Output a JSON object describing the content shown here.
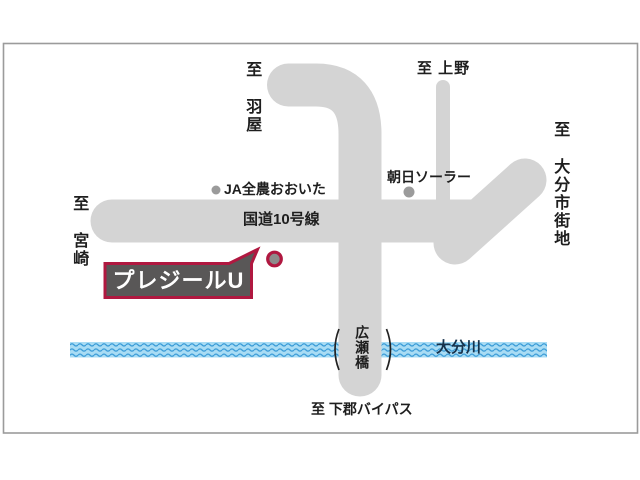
{
  "map": {
    "dealer_callout": {
      "label": "プレジールU"
    },
    "roads": {
      "route10_label": "国道10号線",
      "hirose_bridge_label": "広瀬橋"
    },
    "river": {
      "name": "大分川"
    },
    "destinations": {
      "to_haneya": "至 羽屋",
      "to_ueno": "至 上野",
      "to_oita_city": "至 大分市街地",
      "to_miyazaki": "至 宮崎",
      "to_shimogori_bypass": "至 下郡バイパス"
    },
    "landmarks": {
      "ja_zennoh": "JA全農おおいた",
      "asahi_solar": "朝日ソーラー"
    },
    "colors": {
      "road_gray": "#d4d4d4",
      "callout_accent_red": "#b01840",
      "callout_fill_gray": "#595757",
      "river_light_blue": "#a9dcf4",
      "river_wave_blue": "#399bd7",
      "frame_border_gray": "#9b9b9b",
      "poi_dot_gray": "#9b9b9b"
    }
  }
}
